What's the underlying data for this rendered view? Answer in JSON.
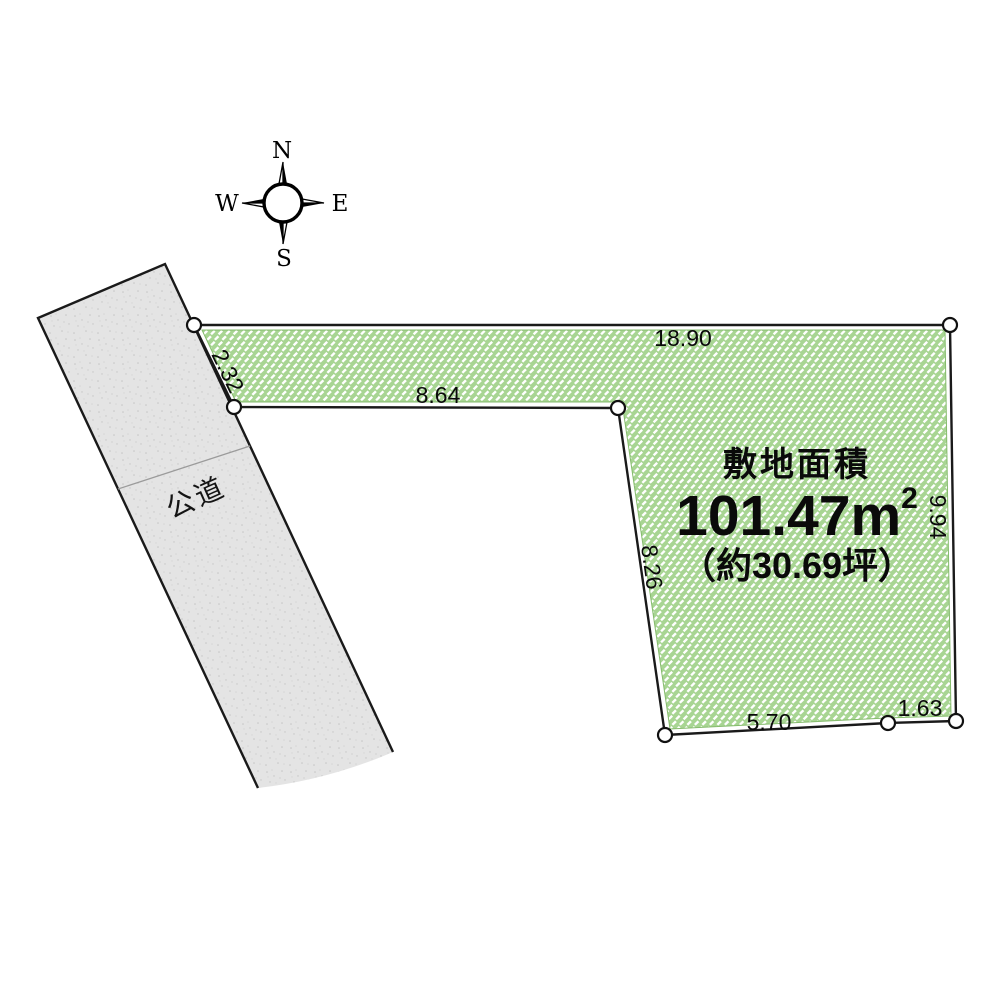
{
  "compass": {
    "north": "N",
    "east": "E",
    "south": "S",
    "west": "W"
  },
  "road": {
    "label": "公道"
  },
  "plot": {
    "area_title": "敷地面積",
    "area_value": "101.47",
    "area_unit": "m",
    "area_unit_exp": "2",
    "area_tsubo": "（約30.69坪）",
    "dimensions": {
      "top": "18.90",
      "left": "2.32",
      "inner_top": "8.64",
      "inner_left": "8.26",
      "right": "9.94",
      "bottom": "5.70",
      "bottom_right": "1.63"
    }
  },
  "colors": {
    "plot_green": "#a8d593",
    "hatch_white": "#ffffff",
    "road_gray": "#e4e4e4",
    "outline": "#1a1a1a"
  }
}
